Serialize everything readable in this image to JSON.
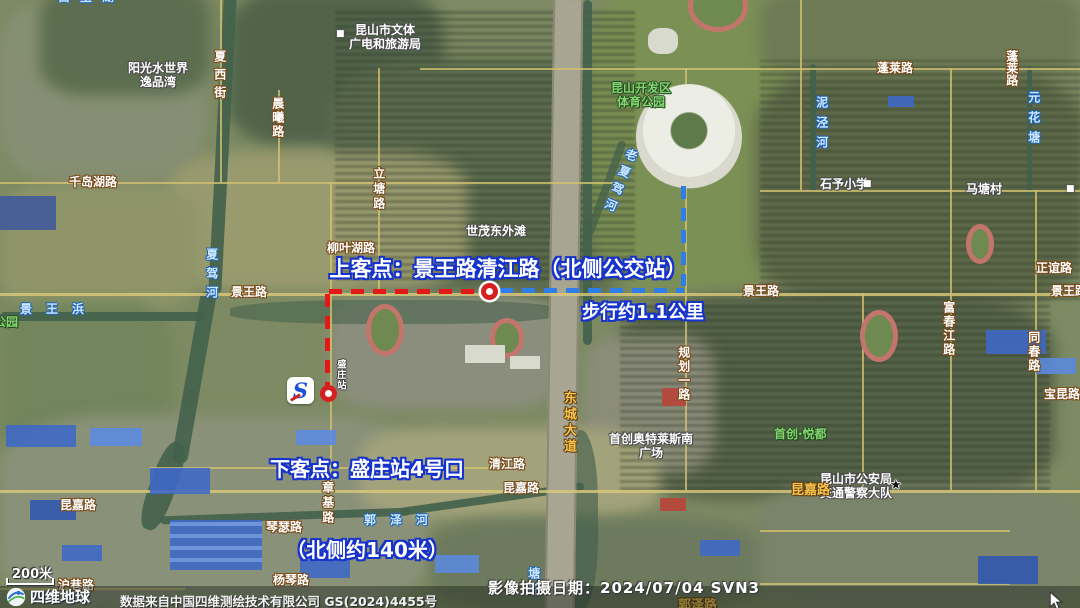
{
  "route": {
    "pickup_label": "上客点：景王路清江路（北侧公交站）",
    "walk_distance_label": "步行约1.1公里",
    "dropoff_label_line1": "下客点：盛庄站4号口",
    "dropoff_label_line2": "（北侧约140米）",
    "colors": {
      "segment_red": "#e31919",
      "segment_blue": "#2e7de8",
      "label_outline_blue": "#1633cc",
      "marker_red": "#d81f1f"
    }
  },
  "map_labels": [
    {
      "text": "白玉湖",
      "type": "water",
      "x": 58,
      "y": -9,
      "ls": 10
    },
    {
      "text": "夏西街",
      "type": "road-white",
      "x": 212,
      "y": 50,
      "v": true,
      "ls": 6
    },
    {
      "text": "晨曦路",
      "type": "road-white",
      "x": 270,
      "y": 97,
      "v": true,
      "ls": 2
    },
    {
      "text": "阳光水世界\n逸品湾",
      "type": "poi-white",
      "x": 158,
      "y": 62,
      "center": true
    },
    {
      "text": "■",
      "type": "icon-white",
      "x": 336,
      "y": 29
    },
    {
      "text": "昆山市文体\n广电和旅游局",
      "type": "poi-white",
      "x": 385,
      "y": 24,
      "center": true
    },
    {
      "text": "昆山开发区\n体育公园",
      "type": "poi-green",
      "x": 641,
      "y": 82,
      "center": true
    },
    {
      "text": "蓬莱路",
      "type": "road-white",
      "x": 877,
      "y": 62
    },
    {
      "text": "蓬莱路",
      "type": "road-white",
      "x": 1004,
      "y": 50,
      "v": true
    },
    {
      "text": "泥泾河",
      "type": "water",
      "x": 814,
      "y": 96,
      "v": true,
      "ls": 8
    },
    {
      "text": "元花塘",
      "type": "water",
      "x": 1026,
      "y": 91,
      "v": true,
      "ls": 8
    },
    {
      "text": "千岛湖路",
      "type": "road-white",
      "x": 69,
      "y": 176
    },
    {
      "text": "石予小学",
      "type": "poi-white",
      "x": 820,
      "y": 178
    },
    {
      "text": "■",
      "type": "icon-white",
      "x": 863,
      "y": 179
    },
    {
      "text": "马塘村",
      "type": "poi-white",
      "x": 966,
      "y": 183
    },
    {
      "text": "■",
      "type": "icon-white",
      "x": 1066,
      "y": 184
    },
    {
      "text": "老夏驾河",
      "type": "water",
      "x": 612,
      "y": 146,
      "v": true,
      "ls": 6,
      "rot": 22
    },
    {
      "text": "立塘路",
      "type": "road-white",
      "x": 371,
      "y": 167,
      "v": true,
      "ls": 3
    },
    {
      "text": "世茂东外滩",
      "type": "poi-white",
      "x": 466,
      "y": 225
    },
    {
      "text": "柳叶湖路",
      "type": "road-white",
      "x": 327,
      "y": 242
    },
    {
      "text": "夏驾河",
      "type": "water",
      "x": 204,
      "y": 248,
      "v": true,
      "ls": 7
    },
    {
      "text": "景王路",
      "type": "road-white",
      "x": 231,
      "y": 286
    },
    {
      "text": "景王路",
      "type": "road-white",
      "x": 743,
      "y": 285
    },
    {
      "text": "正谊路",
      "type": "road-white",
      "x": 1036,
      "y": 262
    },
    {
      "text": "景王路",
      "type": "road-white",
      "x": 1051,
      "y": 285
    },
    {
      "text": "景王浜",
      "type": "water",
      "x": 20,
      "y": 303,
      "ls": 14
    },
    {
      "text": "公园",
      "type": "poi-green",
      "x": -6,
      "y": 316
    },
    {
      "text": "富春江路",
      "type": "road-white",
      "x": 941,
      "y": 301,
      "v": true,
      "ls": 2
    },
    {
      "text": "同春路",
      "type": "road-white",
      "x": 1026,
      "y": 331,
      "v": true,
      "ls": 2
    },
    {
      "text": "宝昆路",
      "type": "road-white",
      "x": 1044,
      "y": 388
    },
    {
      "text": "规划一路",
      "type": "road-white",
      "x": 676,
      "y": 346,
      "v": true,
      "ls": 2
    },
    {
      "text": "东城大道",
      "type": "road-orange",
      "x": 560,
      "y": 391,
      "v": true,
      "ls": 3
    },
    {
      "text": "盛庄站",
      "type": "station",
      "x": 334,
      "y": 359,
      "v": true
    },
    {
      "text": "首创奥特莱斯南\n广场",
      "type": "poi-white",
      "x": 651,
      "y": 433,
      "center": true
    },
    {
      "text": "首创·悦都",
      "type": "poi-green",
      "x": 774,
      "y": 428
    },
    {
      "text": "昆山市公安局\n交通警察大队",
      "type": "poi-white",
      "x": 856,
      "y": 473,
      "center": true
    },
    {
      "text": "★",
      "type": "icon-star",
      "x": 890,
      "y": 479
    },
    {
      "text": "清江路",
      "type": "road-white",
      "x": 489,
      "y": 458
    },
    {
      "text": "昆嘉路",
      "type": "road-white",
      "x": 503,
      "y": 482
    },
    {
      "text": "昆嘉路",
      "type": "road-orange",
      "x": 791,
      "y": 484
    },
    {
      "text": "昆嘉路",
      "type": "road-white",
      "x": 60,
      "y": 499
    },
    {
      "text": "章基路",
      "type": "road-white",
      "x": 320,
      "y": 481,
      "v": true,
      "ls": 3
    },
    {
      "text": "琴瑟路",
      "type": "road-white",
      "x": 266,
      "y": 521
    },
    {
      "text": "杨琴路",
      "type": "road-white",
      "x": 273,
      "y": 574
    },
    {
      "text": "郭泽河",
      "type": "water",
      "x": 364,
      "y": 514,
      "ls": 14
    },
    {
      "text": "沪巷路",
      "type": "road-white",
      "x": 58,
      "y": 579
    },
    {
      "text": "塘郎",
      "type": "water",
      "x": 526,
      "y": 567,
      "v": true,
      "ls": 4
    },
    {
      "text": "郭泽路",
      "type": "road-orange",
      "x": 678,
      "y": 599
    }
  ],
  "footer": {
    "scale_text": "200米",
    "logo_text": "四维地球",
    "attribution": "数据来自中国四维测绘技术有限公司 GS(2024)4455号",
    "capture_date": "影像拍摄日期：2024/07/04 SVN3"
  }
}
